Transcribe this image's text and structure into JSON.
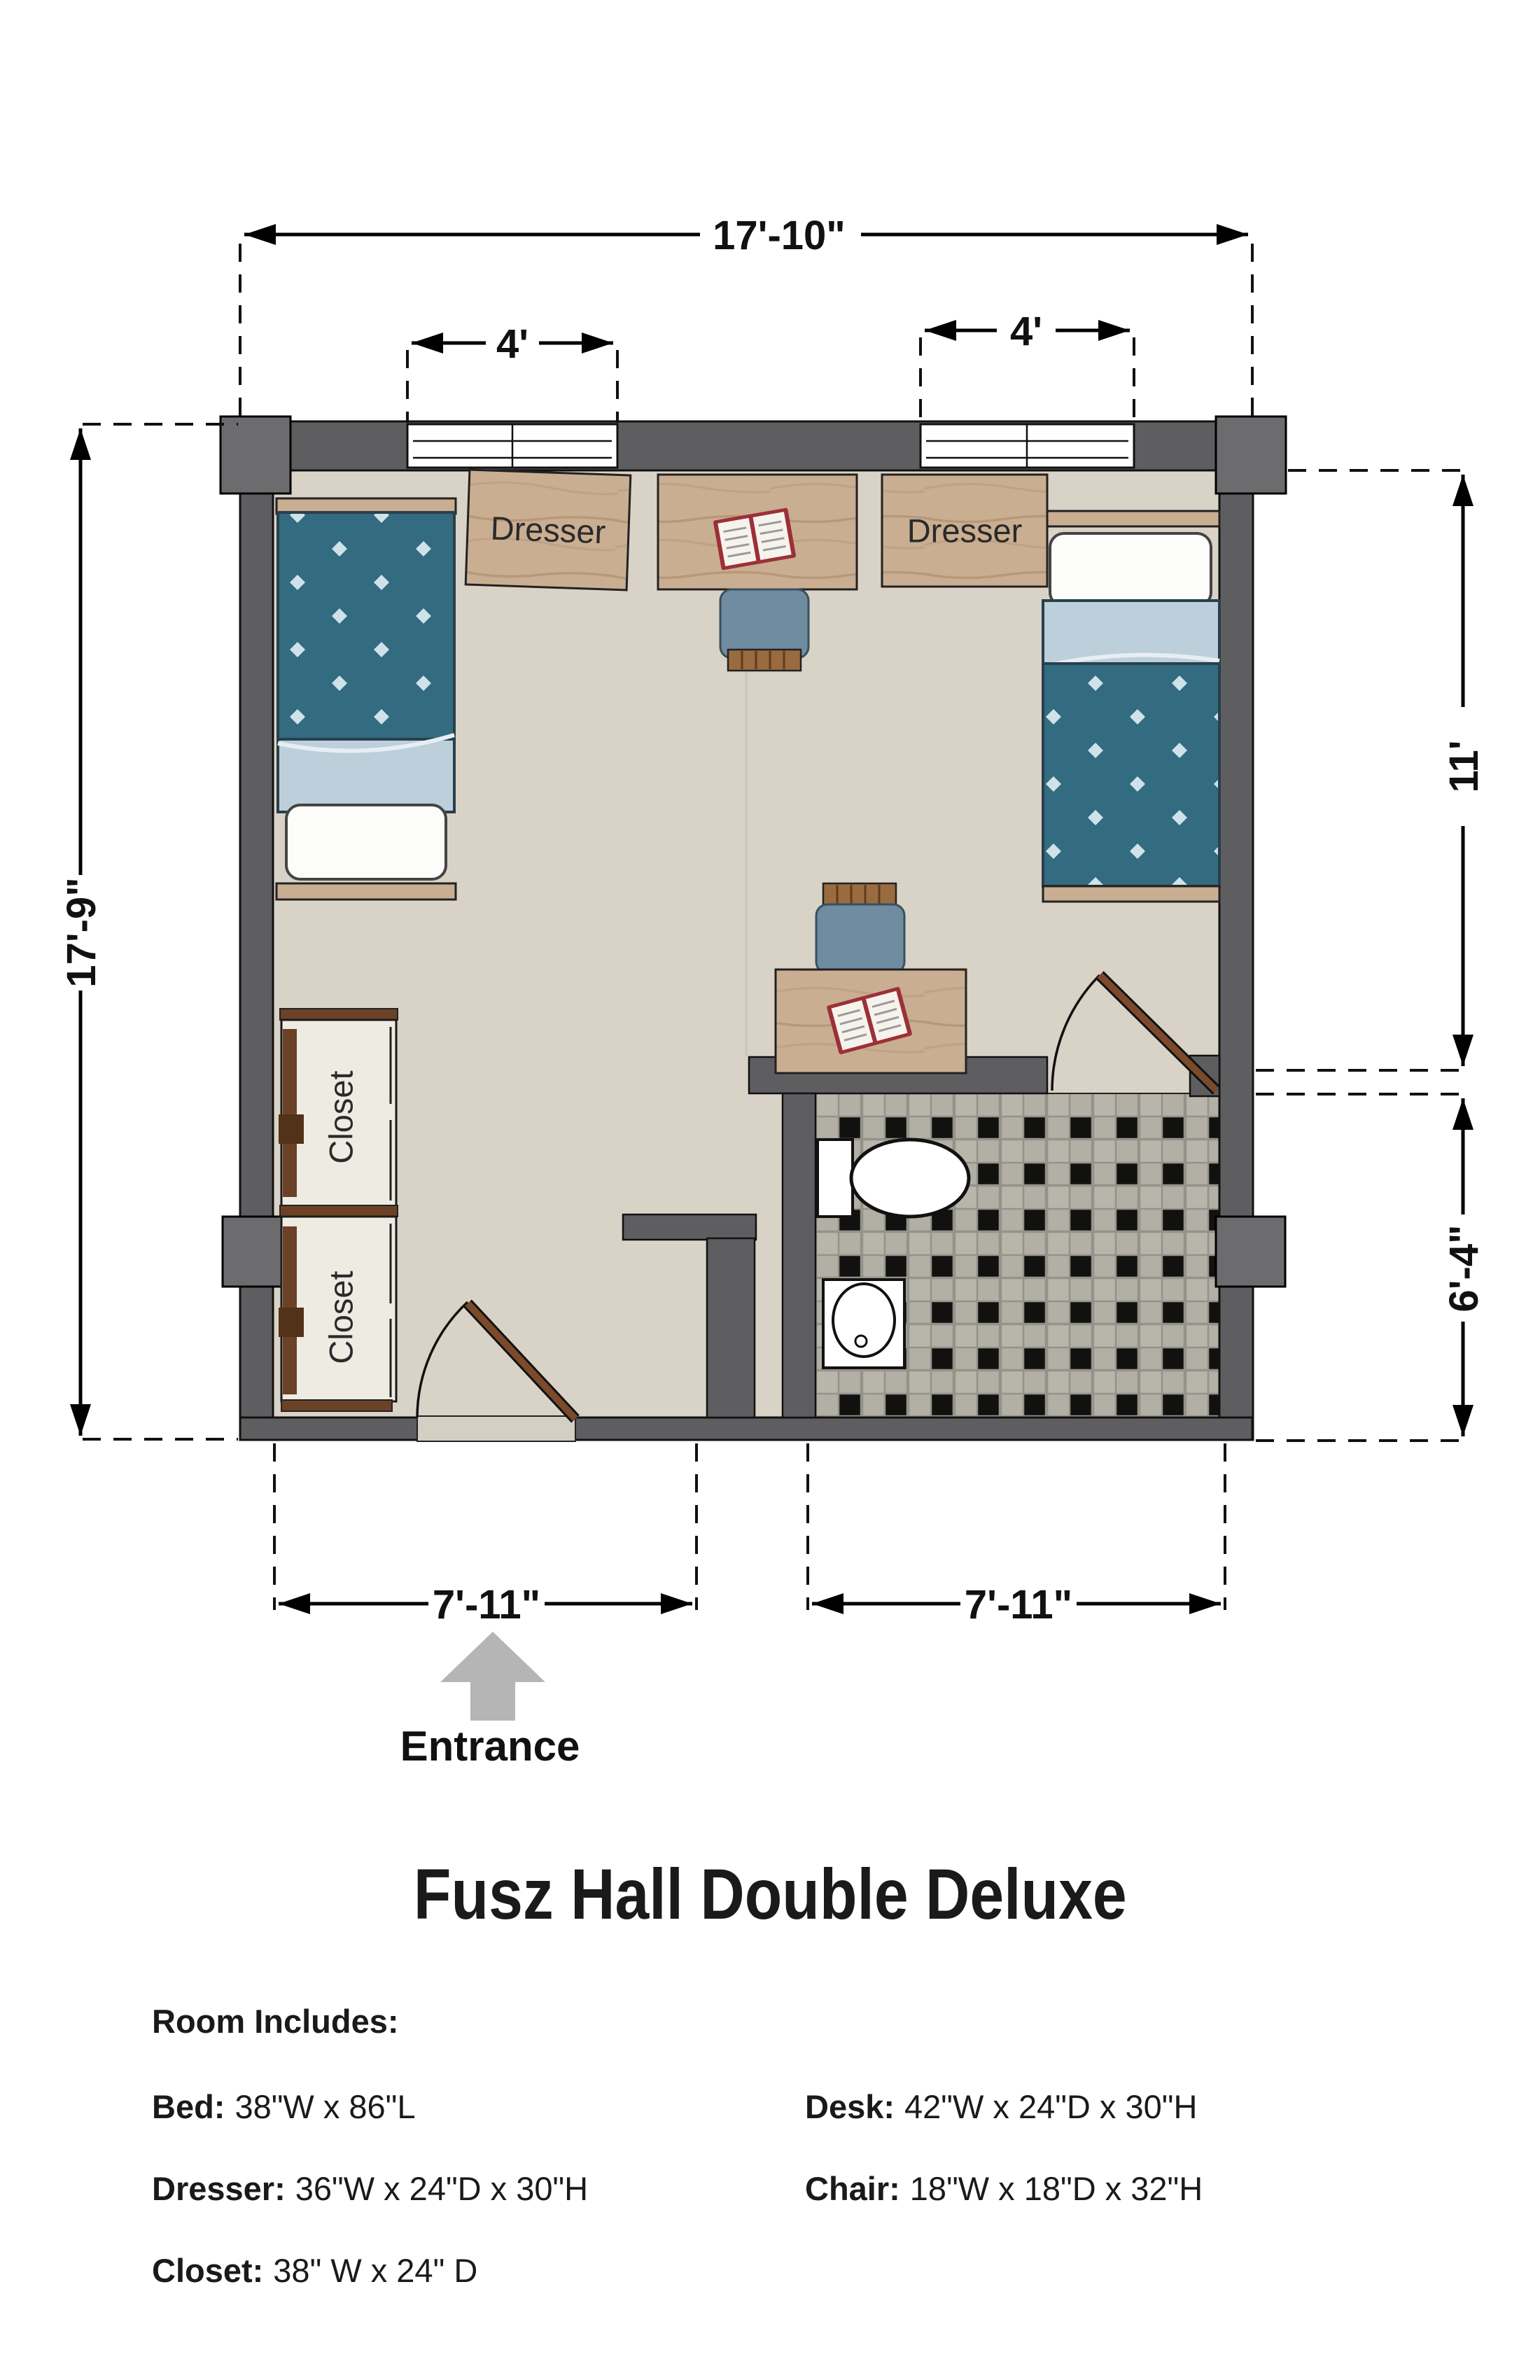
{
  "plan": {
    "dimensions": {
      "overall_width": "17'-10\"",
      "overall_depth": "17'-9\"",
      "window_left": "4'",
      "window_right": "4'",
      "room_depth": "11'",
      "bath_depth": "6'-4\"",
      "bottom_left": "7'-11\"",
      "bottom_right": "7'-11\""
    },
    "labels": {
      "dresser_left": "Dresser",
      "dresser_right": "Dresser",
      "closet_upper": "Closet",
      "closet_lower": "Closet",
      "entrance": "Entrance"
    }
  },
  "title": "Fusz Hall Double Deluxe",
  "legend": {
    "heading": "Room Includes:",
    "left": [
      {
        "label": "Bed:",
        "value": "38\"W x 86\"L"
      },
      {
        "label": "Dresser:",
        "value": "36\"W x 24\"D x 30\"H"
      },
      {
        "label": "Closet:",
        "value": "38\" W x 24\" D"
      }
    ],
    "right": [
      {
        "label": "Desk:",
        "value": "42\"W x 24\"D x 30\"H"
      },
      {
        "label": "Chair:",
        "value": "18\"W x 18\"D x 32\"H"
      }
    ]
  },
  "colors": {
    "wall": "#5e5e60",
    "pilaster": "#6c6c6e",
    "floor": "#d9d3c7",
    "tile": "#b2afa5",
    "bed_blanket": "#336b80",
    "bed_sheet": "#bccfda",
    "wood": "#c9ae91",
    "chair_seat": "#6f8ca0",
    "door_leaf": "#7a4a2b",
    "closet_trim": "#6b4226",
    "entrance_arrow": "#b5b5b5"
  }
}
